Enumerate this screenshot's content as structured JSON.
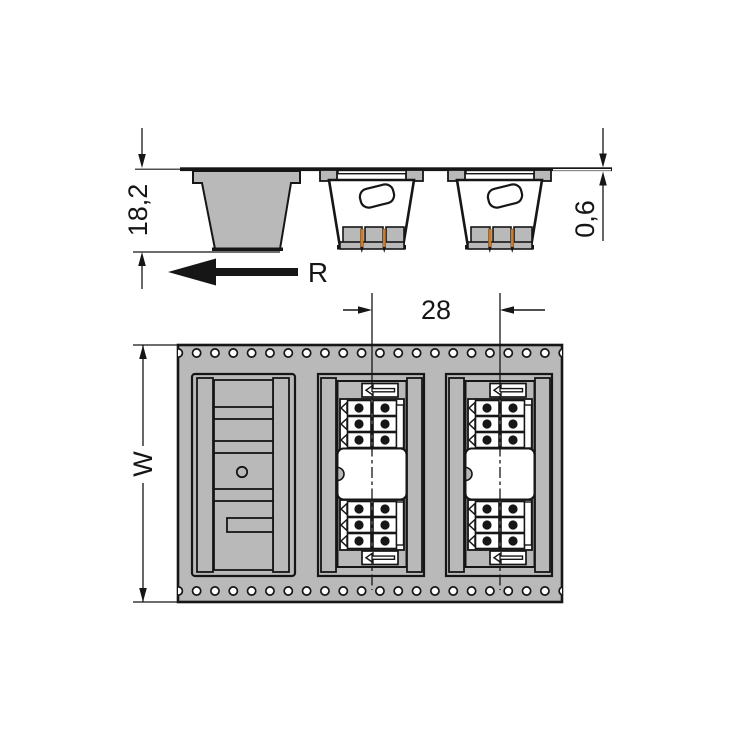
{
  "drawing": {
    "type": "technical-drawing-tape-and-reel",
    "dimensions": {
      "pocket_depth": {
        "label": "18,2"
      },
      "tape_thickness": {
        "label": "0,6"
      },
      "pocket_pitch": {
        "label": "28"
      },
      "tape_width": {
        "label": "W"
      },
      "unreeling_direction": {
        "label": "R"
      }
    },
    "colors": {
      "tape_gray": "#b9b9b9",
      "outline": "#161616",
      "pin_copper": "#c87d35",
      "background": "#ffffff",
      "white": "#ffffff"
    },
    "counts": {
      "sprocket_holes_per_row": 22,
      "sprocket_rows": 2,
      "pockets_side_view": 3,
      "pockets_top_view": 3,
      "contacts_per_connector": 12
    }
  }
}
